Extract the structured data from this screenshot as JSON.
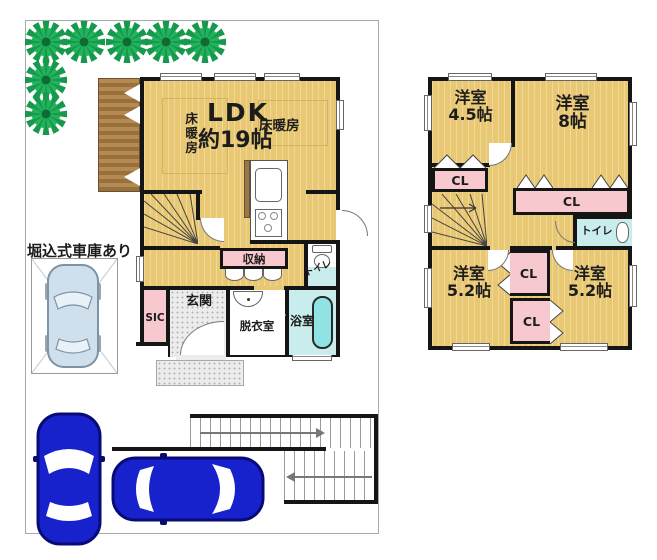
{
  "site": {
    "garage_note": "堀込式車庫あり"
  },
  "floor1": {
    "ldk": "LDK",
    "ldk_size": "約19帖",
    "floor_heating_left": "床暖房",
    "floor_heating_right": "床暖房",
    "storage": "収納",
    "toilet": "トイレ",
    "entrance": "玄関",
    "sic": "SIC",
    "dressing_room": "脱衣室",
    "bathroom": "浴室"
  },
  "floor2": {
    "room_tl": "洋室",
    "room_tl_size": "4.5帖",
    "room_tr": "洋室",
    "room_tr_size": "8帖",
    "room_bl": "洋室",
    "room_bl_size": "5.2帖",
    "room_br": "洋室",
    "room_br_size": "5.2帖",
    "closet_tl": "CL",
    "closet_top": "CL",
    "closet_mid": "CL",
    "closet_bottom": "CL",
    "toilet": "トイレ"
  },
  "colors": {
    "floor_yellow": "#e9c873",
    "closet_pink": "#f7c9ce",
    "wet_area_cyan": "#c9eded",
    "bathtub": "#8fe3e3",
    "deck_brown": "#a87e4e",
    "tree_green": "#15994a",
    "car_blue": "#1822cc",
    "garage_car_lightblue": "#cfe0ec",
    "wall_black": "#151515"
  }
}
